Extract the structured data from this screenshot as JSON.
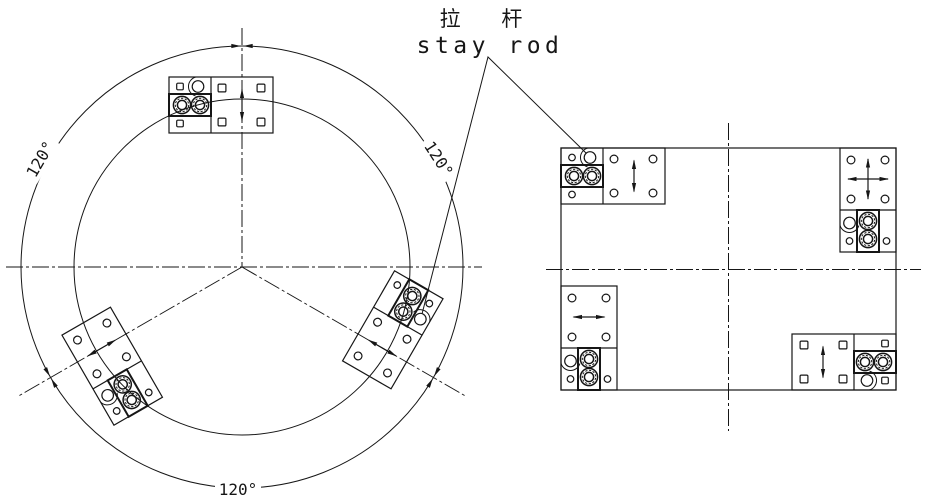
{
  "title": {
    "chinese": "拉 杆",
    "english": "stay rod"
  },
  "colors": {
    "line": "#161616",
    "background": "#ffffff"
  },
  "angle_label_text": "120°",
  "circle_view": {
    "center": {
      "x": 242,
      "y": 267
    },
    "inner_radius": 168,
    "outer_radius": 221,
    "horizontal_centerline": {
      "x1": 6,
      "x2": 482
    },
    "vertical_centerline": {
      "y1": 28
    },
    "radial_length": 258,
    "radial_angles_deg": [
      150,
      30
    ],
    "dim_arrow_angles_deg": [
      270,
      150,
      30
    ],
    "angle_labels": [
      {
        "text": "120°",
        "x": 45,
        "y": 162,
        "rotate": -60
      },
      {
        "text": "120°",
        "x": 434,
        "y": 162,
        "rotate": 57
      },
      {
        "text": "120°",
        "x": 238,
        "y": 495,
        "rotate": 0
      }
    ],
    "modules": [
      {
        "id": "top",
        "transform": "translate(169 77)",
        "arrow": "two-way",
        "holes": "square"
      },
      {
        "id": "lower-right",
        "transform": "rotate(120 242 267) translate(169 77)",
        "arrow": "two-way",
        "holes": "round"
      },
      {
        "id": "lower-left",
        "transform": "rotate(240 242 267) translate(169 77)",
        "arrow": "two-way",
        "holes": "round"
      }
    ]
  },
  "rect_view": {
    "rect": {
      "x": 561,
      "y": 148,
      "width": 335,
      "height": 242
    },
    "vertical_centerline": {
      "x": 728.5,
      "y1": 123,
      "y2": 431
    },
    "horizontal_centerline": {
      "y": 269.5,
      "x1": 546,
      "x2": 921
    },
    "modules": [
      {
        "id": "top-left",
        "transform": "translate(561 148)",
        "arrow": "two-way",
        "holes": "round"
      },
      {
        "id": "top-right",
        "transform": "translate(840 252) rotate(-90)",
        "arrow": "four-way",
        "holes": "round"
      },
      {
        "id": "bottom-left",
        "transform": "translate(561 390) rotate(-90)",
        "arrow": "two-way",
        "holes": "round"
      },
      {
        "id": "bottom-right",
        "transform": "translate(896 390) rotate(180)",
        "arrow": "two-way",
        "holes": "square"
      }
    ]
  },
  "leader": {
    "points": [
      [
        422,
        314
      ],
      [
        488,
        57
      ],
      [
        586,
        153
      ]
    ]
  }
}
